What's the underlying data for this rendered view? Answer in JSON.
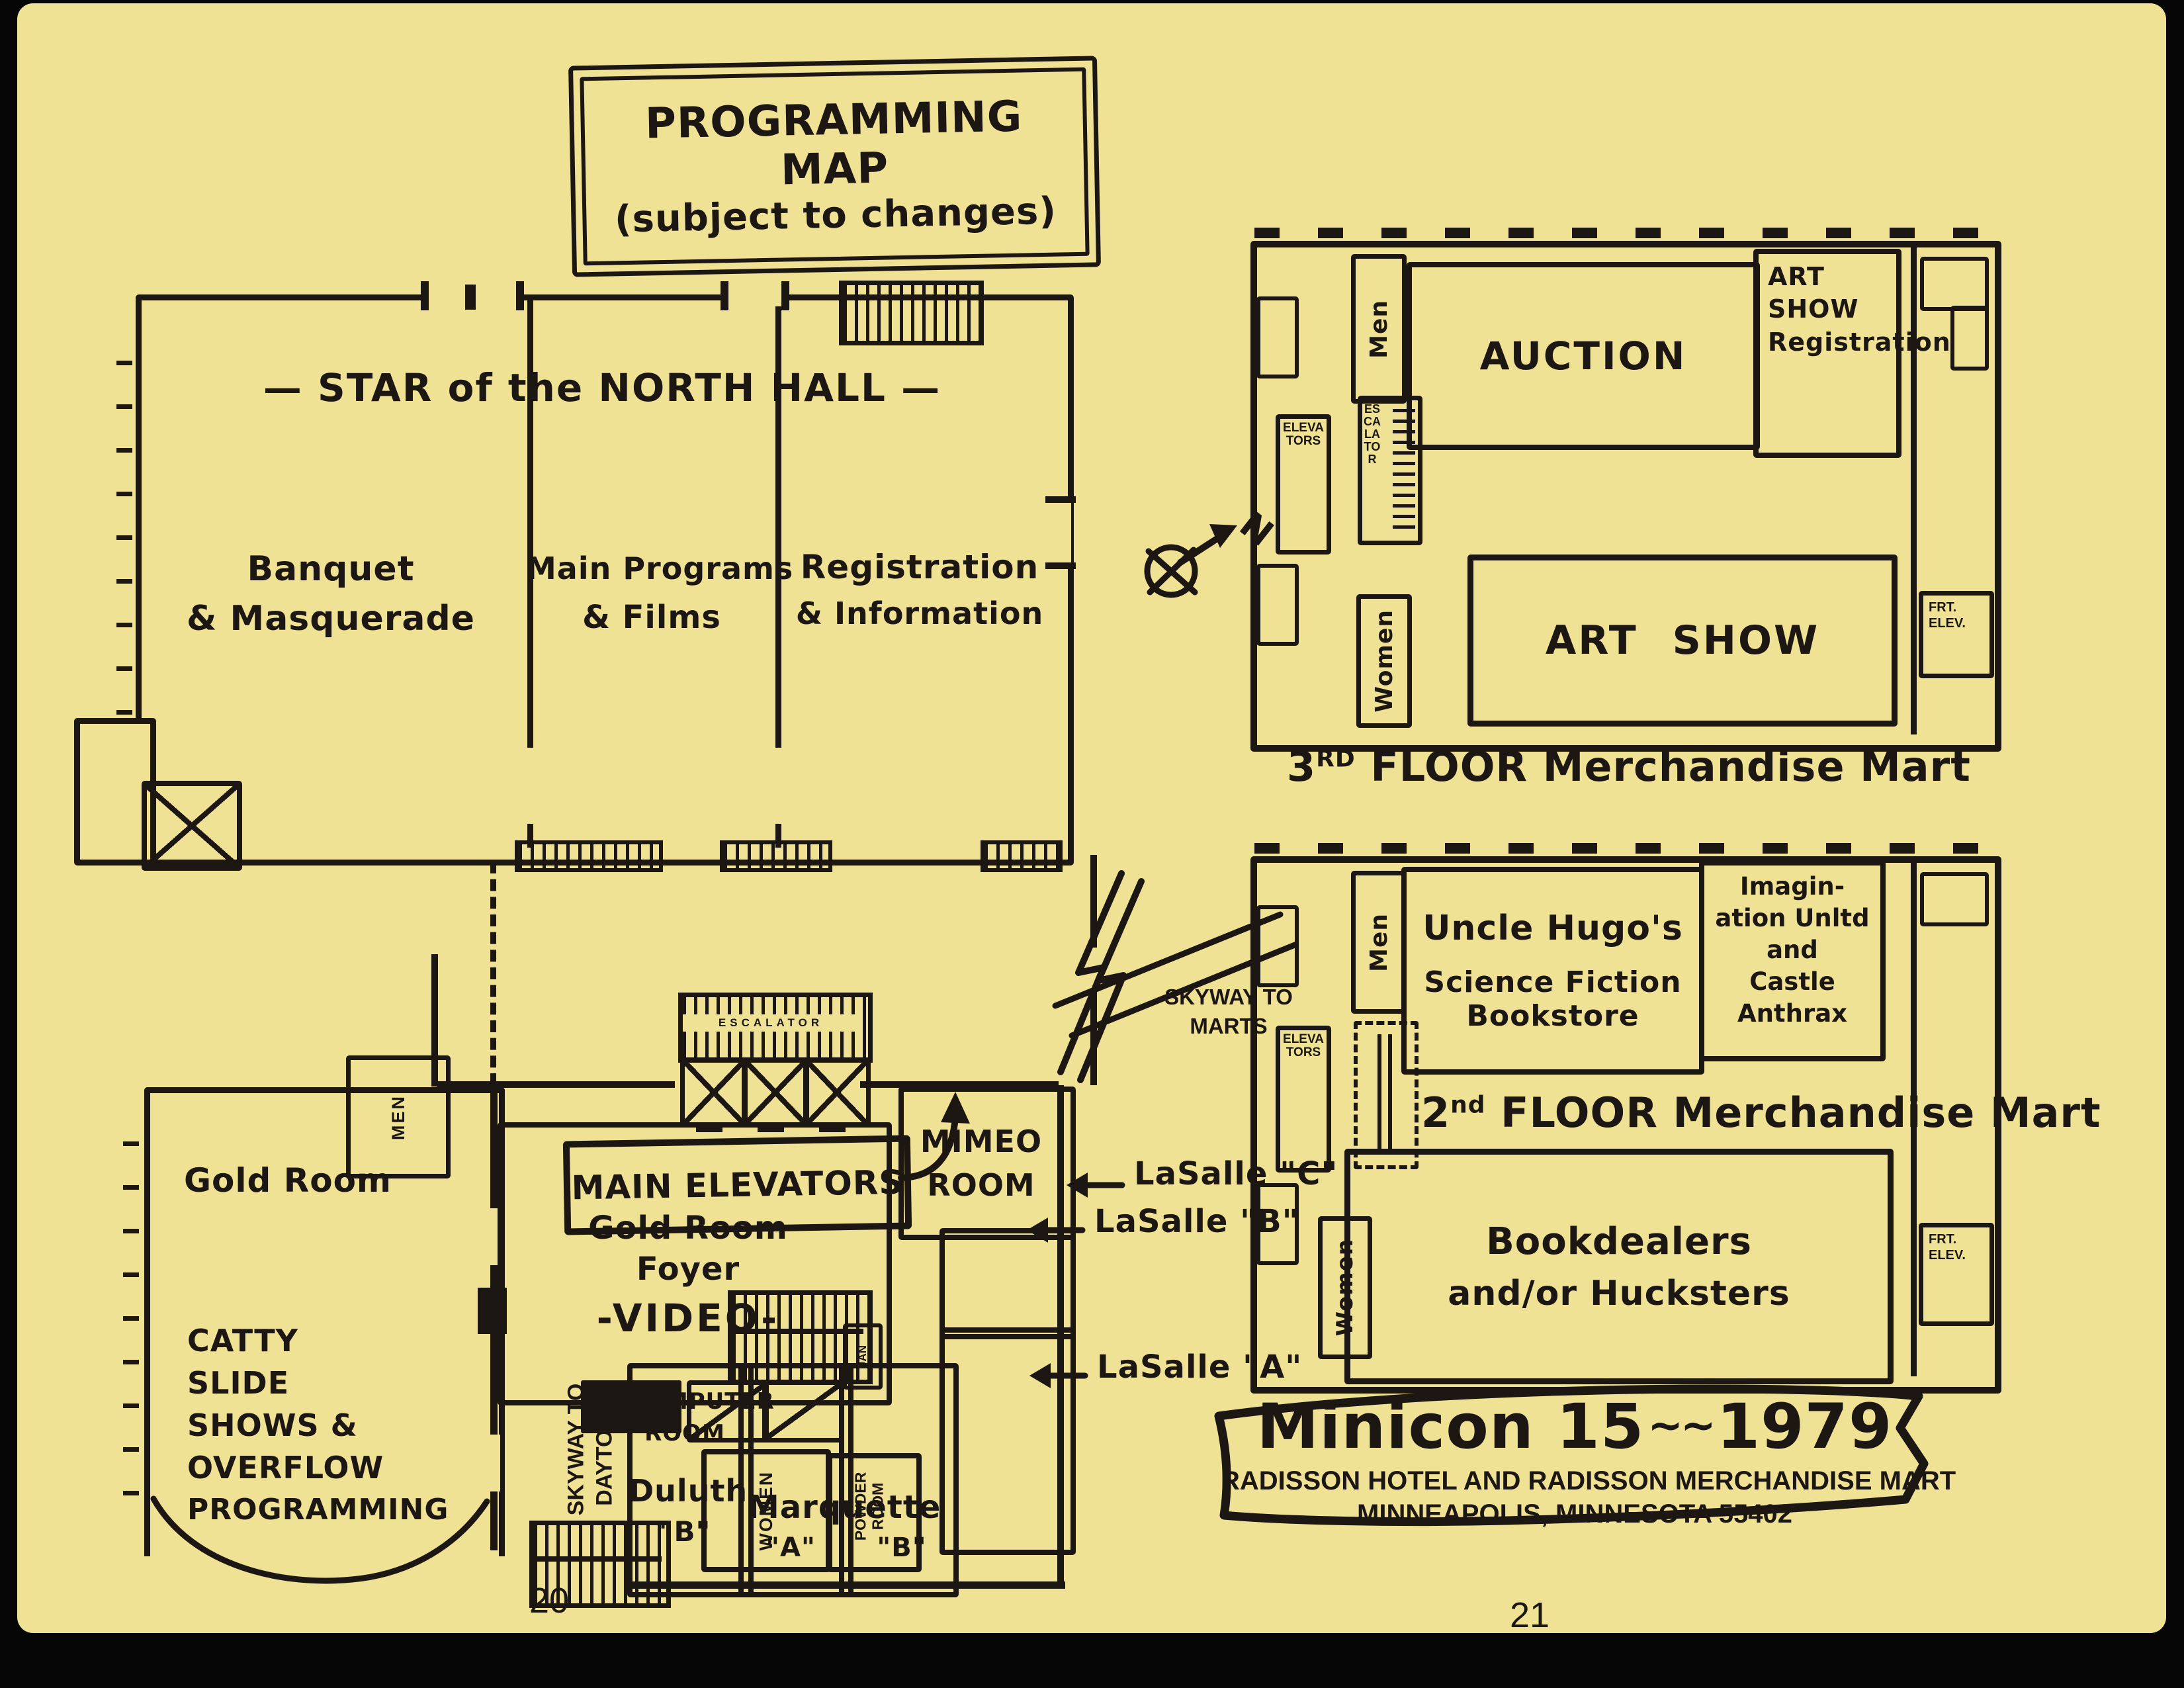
{
  "title_box": {
    "line1": "PROGRAMMING",
    "line2": "MAP",
    "line3": "(subject to changes)"
  },
  "north_hall": {
    "heading": "— STAR of the NORTH HALL —",
    "banquet_l1": "Banquet",
    "banquet_l2": "& Masquerade",
    "programs_l1": "Main Programs",
    "programs_l2": "& Films",
    "registration_l1": "Registration",
    "registration_l2": "& Information"
  },
  "floor3": {
    "men": "Men",
    "auction": "AUCTION",
    "artreg_l1": "ART",
    "artreg_l2": "SHOW",
    "artreg_l3": "Registration",
    "elevators": "ELEVATORS",
    "escalator": "ESCALATOR",
    "women": "Women",
    "art_show": "ART SHOW",
    "frt_l1": "FRT.",
    "frt_l2": "ELEV.",
    "caption_num": "3",
    "caption_sup": "RD",
    "caption_rest": " FLOOR Merchandise Mart"
  },
  "floor2": {
    "men": "Men",
    "hugo_l1": "Uncle Hugo's",
    "hugo_l2": "Science Fiction",
    "hugo_l3": "Bookstore",
    "imag_l1": "Imagin-",
    "imag_l2": "ation Unltd",
    "imag_l3": "and",
    "imag_l4": "Castle",
    "imag_l5": "Anthrax",
    "elevators": "ELEVATORS",
    "caption_num": "2",
    "caption_sup": "nd",
    "caption_rest": " FLOOR Merchandise Mart",
    "book_l1": "Bookdealers",
    "book_l2": "and/or Hucksters",
    "women": "Women",
    "frt_l1": "FRT.",
    "frt_l2": "ELEV."
  },
  "compass": {
    "n": "N"
  },
  "skyway_marts": {
    "l1": "SKYWAY TO",
    "l2": "MARTS"
  },
  "mid": {
    "main_elevators": "MAIN ELEVATORS",
    "escalator": "ESCALATOR",
    "mimeo_l1": "MIMEO",
    "mimeo_l2": "ROOM",
    "lasalle_c": "LaSalle \"C\"",
    "lasalle_b": "LaSalle \"B\"",
    "lasalle_a": "LaSalle \"A\""
  },
  "lower_left": {
    "men": "MEN",
    "gold_room": "Gold Room",
    "foyer_l1": "Gold Room",
    "foyer_l2": "Foyer",
    "video": "-VIDEO-",
    "catty_l1": "CATTY",
    "catty_l2": "SLIDE",
    "catty_l3": "SHOWS &",
    "catty_l4": "OVERFLOW",
    "catty_l5": "PROGRAMMING",
    "jan": "JAN",
    "women": "WOMEN",
    "powder_l1": "POWDER",
    "powder_l2": "ROOM",
    "skyway_l1": "SKYWAY TO",
    "skyway_l2": "DAYTON'S",
    "computer_l1": "COMPUTER",
    "computer_l2": "ROOM",
    "computer_l3": "Duluth",
    "computer_l4": "\"B\"",
    "marquette": "Marquette",
    "marq_a": "\"A\"",
    "marq_b": "\"B\""
  },
  "banner": {
    "title": "Minicon 15",
    "squiggle": "~~",
    "year": "1979",
    "line2": "RADISSON HOTEL AND RADISSON MERCHANDISE MART",
    "line3": "MINNEAPOLIS, MINNESOTA  55402"
  },
  "pages": {
    "left": "20",
    "right": "21"
  },
  "colors": {
    "paper": "#f0e294",
    "ink": "#1c1712"
  }
}
